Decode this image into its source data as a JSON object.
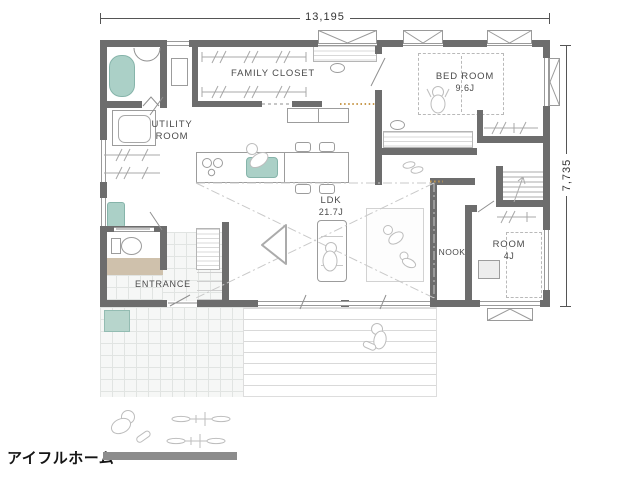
{
  "brand": {
    "name": "アイフルホーム"
  },
  "dimensions": {
    "width": "13,195",
    "depth": "7,735"
  },
  "rooms": {
    "family_closet": {
      "label": "FAMILY CLOSET"
    },
    "bed_room": {
      "label": "BED ROOM",
      "size": "9.6J"
    },
    "utility_room": {
      "label": "UTILITY ROOM"
    },
    "ldk": {
      "label": "LDK",
      "size": "21.7J"
    },
    "nook": {
      "label": "NOOK"
    },
    "room_4j": {
      "label": "ROOM",
      "size": "4J"
    },
    "entrance": {
      "label": "ENTRANCE"
    }
  },
  "fixtures": [
    "bathtub",
    "washing-machine",
    "drying-poles",
    "toilet",
    "vanity-sink",
    "linen-shelf",
    "kitchen-stove",
    "kitchen-sink",
    "kitchen-counter",
    "pantry-cabinet",
    "dining-chairs",
    "sofa",
    "rug",
    "play-tent",
    "double-bed",
    "bedroom-desk",
    "study-counter",
    "closet-hangers",
    "stairs-up",
    "futon",
    "room-desk",
    "shoe-cabinet",
    "entrance-steps",
    "genkan-step",
    "entrance-tile",
    "approach-tile",
    "doormat",
    "wood-deck",
    "people-figures",
    "bicycles",
    "slippers"
  ],
  "colors": {
    "wall": "#6d6d6d",
    "fixture_teal": "#abd0c7",
    "genkan_tan": "#cfc1ac",
    "pass_dot": "#c89a4e",
    "logo_bar": "#8c8c8c"
  }
}
